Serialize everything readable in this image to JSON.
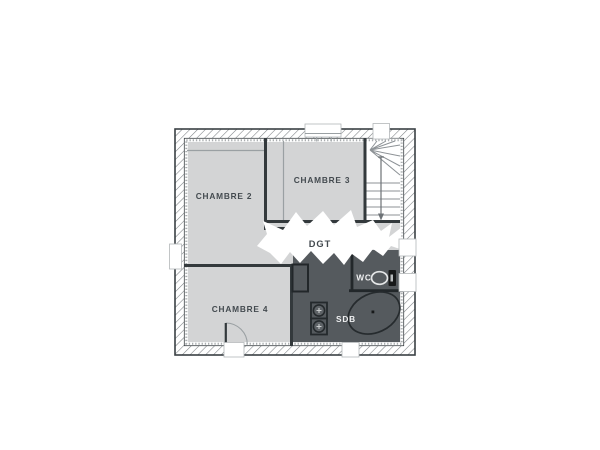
{
  "floorplan": {
    "type": "floor-plan",
    "rooms": {
      "chambre_2": {
        "label": "CHAMBRE 2"
      },
      "chambre_3": {
        "label": "CHAMBRE 3"
      },
      "chambre_4": {
        "label": "CHAMBRE 4"
      },
      "degagement": {
        "label": "DGT"
      },
      "wc": {
        "label": "WC"
      },
      "salle_de_bain": {
        "label": "SDB"
      }
    },
    "colors": {
      "room_fill": "#d3d4d5",
      "wet_room_fill": "#555a5e",
      "stair_fill": "#ffffff",
      "wall_outline": "#3a4044",
      "interior_wall": "#33393c",
      "dark_wall": "#22272a",
      "hatch_line": "#7a7f83",
      "insulation_dot": "#a9adaf",
      "thin_line": "#9aa0a3",
      "stair_line": "#8d9296",
      "label_dark": "#434a4f",
      "label_light": "#eff0f1",
      "fixture_dark": "#17191a",
      "fixture_light": "#e4e6e7",
      "window_border": "#b3b7b9"
    }
  }
}
